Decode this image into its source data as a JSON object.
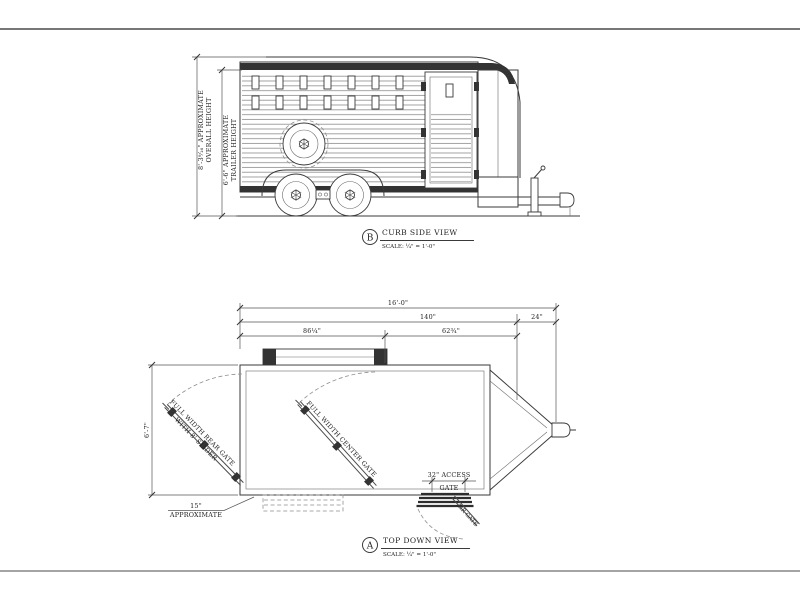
{
  "sheet": {
    "bg": "#ffffff",
    "line_color": "#3a3a3a"
  },
  "side_view": {
    "badge": "B",
    "title": "CURB SIDE VIEW",
    "scale": "SCALE: ¼\" = 1'-0\"",
    "dim_overall_height_value": "8'-3⁹⁄₁₆\" APPROXIMATE",
    "dim_overall_height_label": "OVERALL HEIGHT",
    "dim_trailer_height_value": "6'-6\" APPROXIMATE",
    "dim_trailer_height_label": "TRAILER HEIGHT"
  },
  "top_view": {
    "badge": "A",
    "title": "TOP DOWN VIEW",
    "scale": "SCALE: ¼\" = 1'-0\"",
    "dim_overall_length": "16'-0\"",
    "dim_body_length": "140\"",
    "dim_tongue_length": "24\"",
    "dim_rear_section": "86¼\"",
    "dim_front_section": "62¾\"",
    "dim_width": "6'-7\"",
    "dim_rear_offset_value": "15\"",
    "dim_rear_offset_label": "APPROXIMATE",
    "label_access_gate_l1": "32\" ACCESS",
    "label_access_gate_l2": "GATE",
    "label_rear_gate_l1": "FULL WIDTH REAR GATE",
    "label_rear_gate_l2": "WITH 8' SLIDER",
    "label_center_gate": "FULL WIDTH CENTER GATE",
    "label_air_gate": "AIR GATE"
  }
}
